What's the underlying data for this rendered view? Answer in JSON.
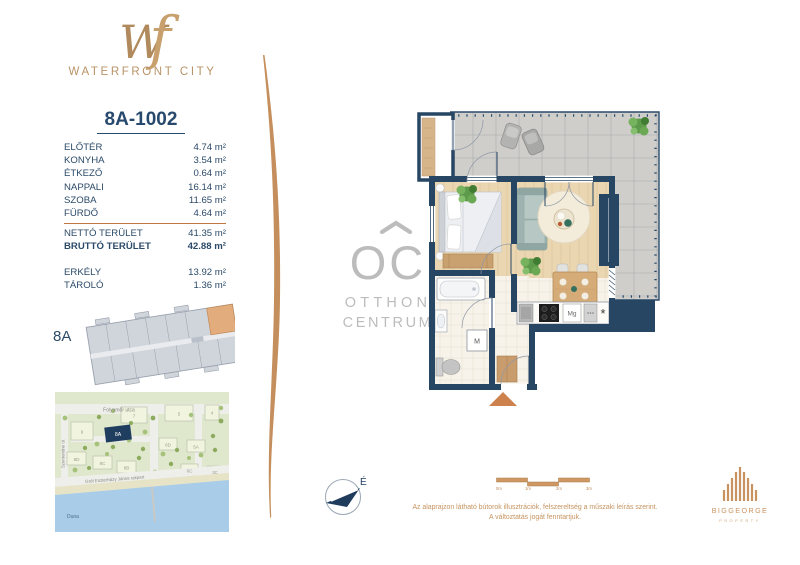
{
  "brand": {
    "monogram_w": "W",
    "monogram_f": "f",
    "name": "WATERFRONT CITY"
  },
  "unit": {
    "id": "8A-1002"
  },
  "areas": {
    "rooms": [
      {
        "label": "ELŐTÉR",
        "value": "4.74 m²"
      },
      {
        "label": "KONYHA",
        "value": "3.54 m²"
      },
      {
        "label": "ÉTKEZŐ",
        "value": "0.64 m²"
      },
      {
        "label": "NAPPALI",
        "value": "16.14 m²"
      },
      {
        "label": "SZOBA",
        "value": "11.65 m²"
      },
      {
        "label": "FÜRDŐ",
        "value": "4.64 m²"
      }
    ],
    "totals": [
      {
        "label": "NETTÓ TERÜLET",
        "value": "41.35 m²"
      },
      {
        "label": "BRUTTÓ TERÜLET",
        "value": "42.88 m²"
      }
    ],
    "extras": [
      {
        "label": "ERKÉLY",
        "value": "13.92 m²"
      },
      {
        "label": "TÁROLÓ",
        "value": "1.36 m²"
      }
    ]
  },
  "building": {
    "label": "8A"
  },
  "map": {
    "street_top": "Folyamőr utca",
    "street_left": "Szentendrei út",
    "embankment": "Gróf Eszterházy János rakpart",
    "river": "Duna",
    "highlight_label": "8A",
    "building_labels": [
      "9",
      "7",
      "5",
      "4",
      "6D",
      "5A",
      "8D",
      "8C",
      "8B",
      "6C",
      "3C"
    ]
  },
  "floorplan": {
    "washer": "M",
    "microwave": "Mg",
    "fridge": "*"
  },
  "watermark": {
    "logo": "OC",
    "line1": "OTTHON",
    "line2": "CENTRUM"
  },
  "compass": {
    "north": "É"
  },
  "scalebar": {
    "t0": "0m",
    "t1": "1m",
    "t2": "2m",
    "t3": "3m"
  },
  "footer": {
    "disclaimer_line1": "Az alaprajzon látható bútorok illusztrációk, felszereltség a műszaki leírás szerint.",
    "disclaimer_line2": "A változtatás jogát fenntartjuk.",
    "developer": "BIGGEORGE",
    "developer_sub": "PROPERTY"
  },
  "colors": {
    "navy": "#27496d",
    "tan": "#c0905f",
    "accent_orange": "#c1773f"
  }
}
